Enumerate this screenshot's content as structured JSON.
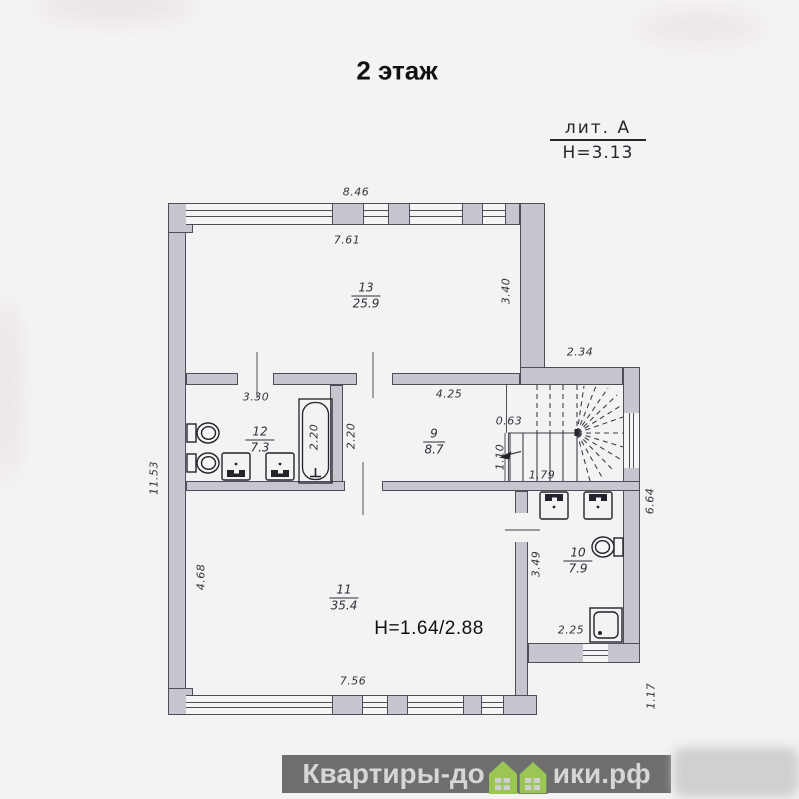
{
  "title": "2 этаж",
  "legend": {
    "lit": "лит. А",
    "height": "Н=3.13"
  },
  "height_note": "Н=1.64/2.88",
  "rooms": {
    "r13": {
      "num": "13",
      "area": "25.9"
    },
    "r12": {
      "num": "12",
      "area": "7.3"
    },
    "r9": {
      "num": "9",
      "area": "8.7"
    },
    "r11": {
      "num": "11",
      "area": "35.4"
    },
    "r10": {
      "num": "10",
      "area": "7.9"
    }
  },
  "dims": {
    "top_width": "8.46",
    "r13_width": "7.61",
    "r13_height": "3.40",
    "ext_width": "2.34",
    "left_height": "11.53",
    "r12_width": "3.30",
    "r9_width": "4.25",
    "stair_gap": "0.63",
    "bath_length": "2.20",
    "r9_height": "2.20",
    "stair_wall": "1.10",
    "stair_run": "1.79",
    "right_height": "6.64",
    "r11_left_height": "4.68",
    "r10_left_height": "3.49",
    "r10_width": "2.25",
    "r11_width": "7.56",
    "step_height": "1.17"
  },
  "watermark": {
    "left": "Квартиры-до",
    "right": "ики.рф",
    "full": "Квартиры-домики.рф"
  },
  "fixtures": {
    "room12": [
      "toilet",
      "toilet",
      "sink",
      "sink",
      "bathtub"
    ],
    "room10": [
      "sink",
      "sink",
      "toilet",
      "shower-tray"
    ],
    "stairs": "winder-staircase"
  },
  "colors": {
    "wall_fill": "#c6c6ce",
    "line": "#4e4e58",
    "watermark_bar": "#6e6e6e",
    "watermark_text": "#d6d6d6",
    "watermark_house": "#9cc653",
    "background": "#f4f2f3"
  }
}
